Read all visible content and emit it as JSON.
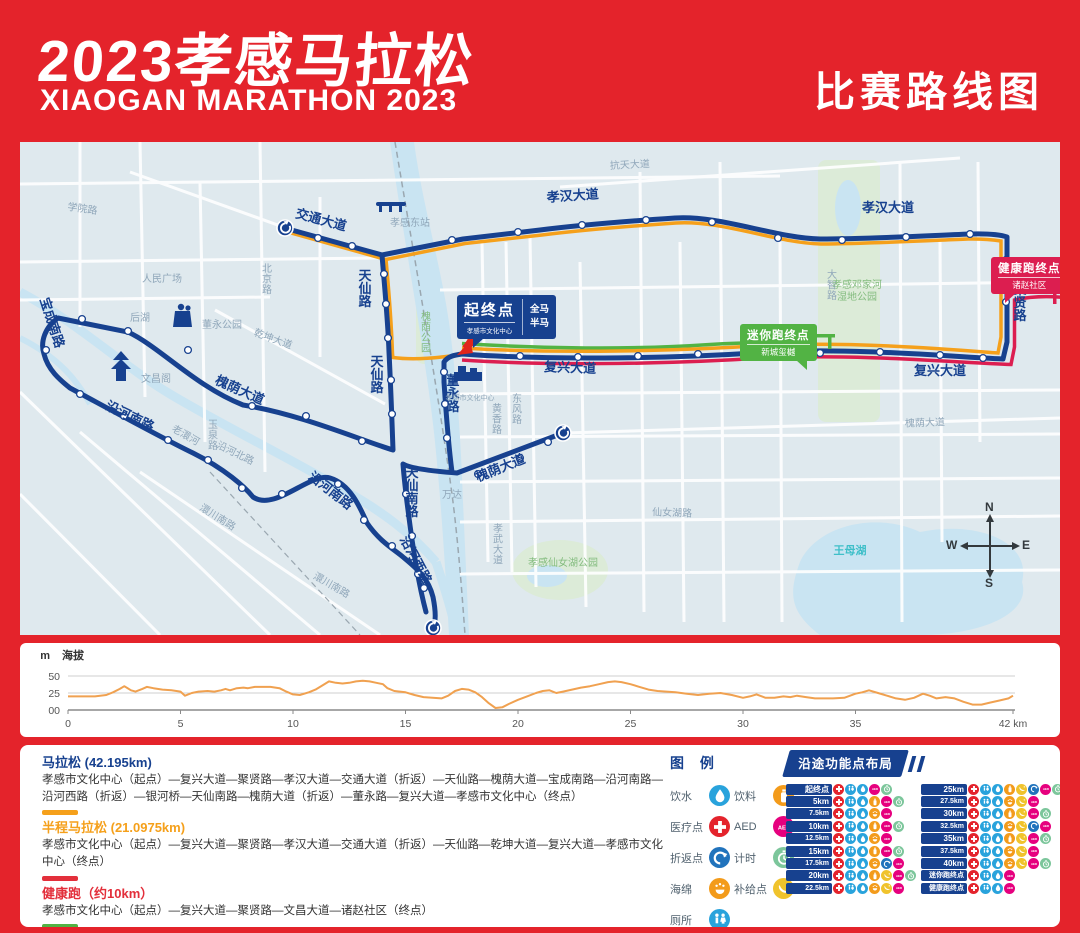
{
  "header": {
    "title_cn": "2023孝感马拉松",
    "title_en": "XIAOGAN MARATHON 2023",
    "right_label": "比赛路线图"
  },
  "map": {
    "start_callout": {
      "title": "起终点",
      "venue": "孝感市文化中心",
      "tag1": "全马",
      "tag2": "半马"
    },
    "mini_callout": {
      "title": "迷你跑终点",
      "venue": "新城玺樾"
    },
    "health_callout": {
      "title": "健康跑终点",
      "venue": "诸赵社区"
    },
    "compass": {
      "n": "N",
      "e": "E",
      "s": "S",
      "w": "W"
    },
    "labels": [
      {
        "t": "交通大道",
        "x": 300,
        "y": 82,
        "r": 15,
        "c": "rl"
      },
      {
        "t": "孝汉大道",
        "x": 553,
        "y": 58,
        "r": -4,
        "c": "rl"
      },
      {
        "t": "孝汉大道",
        "x": 868,
        "y": 70,
        "r": 0,
        "c": "rl"
      },
      {
        "t": "天仙路",
        "x": 345,
        "y": 138,
        "r": "V",
        "c": "rl"
      },
      {
        "t": "天仙路",
        "x": 357,
        "y": 224,
        "r": "V",
        "c": "rl"
      },
      {
        "t": "天仙南路",
        "x": 392,
        "y": 335,
        "r": "V",
        "c": "rl"
      },
      {
        "t": "聚贤路",
        "x": 1000,
        "y": 152,
        "r": "V",
        "c": "rl"
      },
      {
        "t": "董永路",
        "x": 433,
        "y": 243,
        "r": "V",
        "c": "rl"
      },
      {
        "t": "复兴大道",
        "x": 550,
        "y": 230,
        "r": 2,
        "c": "rl"
      },
      {
        "t": "复兴大道",
        "x": 920,
        "y": 233,
        "r": 0,
        "c": "rl"
      },
      {
        "t": "槐荫大道",
        "x": 218,
        "y": 252,
        "r": 24,
        "c": "rl"
      },
      {
        "t": "槐荫大道",
        "x": 482,
        "y": 330,
        "r": -22,
        "c": "rl"
      },
      {
        "t": "宝成南路",
        "x": 28,
        "y": 182,
        "r": 72,
        "c": "rl"
      },
      {
        "t": "沿河南路",
        "x": 108,
        "y": 278,
        "r": 26,
        "c": "rl"
      },
      {
        "t": "沿河南路",
        "x": 308,
        "y": 352,
        "r": 38,
        "c": "rl"
      },
      {
        "t": "沿河西路",
        "x": 392,
        "y": 420,
        "r": 62,
        "c": "rl"
      },
      {
        "t": "学院路",
        "x": 62,
        "y": 70,
        "r": 8,
        "c": "gl"
      },
      {
        "t": "人民广场",
        "x": 142,
        "y": 140,
        "r": 0,
        "c": "gl"
      },
      {
        "t": "后湖",
        "x": 120,
        "y": 179,
        "r": 0,
        "c": "gl"
      },
      {
        "t": "北京路",
        "x": 247,
        "y": 130,
        "r": "V",
        "c": "gl"
      },
      {
        "t": "孝感东站",
        "x": 390,
        "y": 84,
        "r": 0,
        "c": "gl"
      },
      {
        "t": "抗天大道",
        "x": 610,
        "y": 26,
        "r": -3,
        "c": "gl"
      },
      {
        "t": "乾坤大道",
        "x": 252,
        "y": 200,
        "r": 20,
        "c": "gl"
      },
      {
        "t": "董永公园",
        "x": 202,
        "y": 186,
        "r": 0,
        "c": "gl"
      },
      {
        "t": "文昌阁",
        "x": 136,
        "y": 240,
        "r": 0,
        "c": "gl"
      },
      {
        "t": "大智路",
        "x": 812,
        "y": 136,
        "r": "V",
        "c": "gl"
      },
      {
        "t": "槐荫大道",
        "x": 905,
        "y": 284,
        "r": -2,
        "c": "gl"
      },
      {
        "t": "仙女湖路",
        "x": 652,
        "y": 374,
        "r": 2,
        "c": "gl"
      },
      {
        "t": "孝武大道",
        "x": 478,
        "y": 390,
        "r": "V",
        "c": "gl"
      },
      {
        "t": "澴川南路",
        "x": 196,
        "y": 378,
        "r": 32,
        "c": "gl"
      },
      {
        "t": "澴川南路",
        "x": 310,
        "y": 446,
        "r": 30,
        "c": "gl"
      },
      {
        "t": "万达",
        "x": 432,
        "y": 356,
        "r": 0,
        "c": "gl"
      },
      {
        "t": "黄香路",
        "x": 477,
        "y": 270,
        "r": "V",
        "c": "gl"
      },
      {
        "t": "东风路",
        "x": 497,
        "y": 260,
        "r": "V",
        "c": "gl"
      },
      {
        "t": "玉泉路",
        "x": 193,
        "y": 286,
        "r": "V",
        "c": "gl"
      },
      {
        "t": "沿河北路",
        "x": 214,
        "y": 314,
        "r": 26,
        "c": "gl"
      },
      {
        "t": "老澴河",
        "x": 164,
        "y": 296,
        "r": 30,
        "c": "gl"
      },
      {
        "t": "槐荫公园",
        "x": 406,
        "y": 178,
        "r": "V",
        "c": "pk"
      },
      {
        "t": "孝感仙女湖公园",
        "x": 543,
        "y": 424,
        "r": 0,
        "c": "pk"
      },
      {
        "t": "孝感邓家河",
        "x": 837,
        "y": 146,
        "r": 0,
        "c": "pk"
      },
      {
        "t": "湿地公园",
        "x": 837,
        "y": 158,
        "r": 0,
        "c": "pk"
      },
      {
        "t": "王母湖",
        "x": 830,
        "y": 412,
        "r": 0,
        "c": "wl"
      },
      {
        "t": "孝感市文化中心",
        "x": 450,
        "y": 258,
        "r": 0,
        "c": "gl2"
      }
    ]
  },
  "elevation": {
    "unit": "m",
    "axis_label": "海拔",
    "yticks": [
      "50",
      "25",
      "00"
    ],
    "xtick_last": "42 km"
  },
  "chart_data": {
    "type": "line",
    "title": "海拔",
    "ylabel": "m",
    "xlabel": "km",
    "ylim": [
      0,
      50
    ],
    "yticks": [
      0,
      25,
      50
    ],
    "xticks": [
      0,
      5,
      10,
      15,
      20,
      25,
      30,
      35,
      42
    ],
    "legend_position": "none",
    "grid": true,
    "series": [
      {
        "name": "海拔",
        "color": "#F0A150",
        "points_km_m": [
          [
            0,
            20
          ],
          [
            0.7,
            20
          ],
          [
            1.2,
            20
          ],
          [
            1.7,
            22
          ],
          [
            2,
            26
          ],
          [
            2.3,
            31
          ],
          [
            2.5,
            35
          ],
          [
            2.8,
            29
          ],
          [
            3,
            27
          ],
          [
            3.3,
            31
          ],
          [
            3.5,
            34
          ],
          [
            3.8,
            32
          ],
          [
            4.2,
            30
          ],
          [
            4.6,
            29
          ],
          [
            5,
            27
          ],
          [
            5.2,
            21
          ],
          [
            5.5,
            25
          ],
          [
            5.8,
            27
          ],
          [
            6.2,
            28
          ],
          [
            6.5,
            27
          ],
          [
            6.8,
            29
          ],
          [
            7,
            31
          ],
          [
            7.2,
            29
          ],
          [
            7.5,
            32
          ],
          [
            7.8,
            33
          ],
          [
            8,
            32
          ],
          [
            8.3,
            34
          ],
          [
            8.7,
            34
          ],
          [
            9,
            34
          ],
          [
            9.4,
            32
          ],
          [
            9.7,
            27
          ],
          [
            10,
            23
          ],
          [
            10.3,
            22
          ],
          [
            10.7,
            26
          ],
          [
            11,
            30
          ],
          [
            11.3,
            36
          ],
          [
            11.6,
            42
          ],
          [
            11.9,
            40
          ],
          [
            12.2,
            39
          ],
          [
            12.5,
            40
          ],
          [
            12.8,
            42
          ],
          [
            13.1,
            43
          ],
          [
            13.4,
            42
          ],
          [
            13.7,
            40
          ],
          [
            14,
            38
          ],
          [
            14.2,
            32
          ],
          [
            14.5,
            28
          ],
          [
            15,
            26
          ],
          [
            15.4,
            22
          ],
          [
            15.8,
            19
          ],
          [
            16.2,
            18
          ],
          [
            16.6,
            17
          ],
          [
            16.9,
            21
          ],
          [
            17.2,
            28
          ],
          [
            17.5,
            31
          ],
          [
            17.8,
            30
          ],
          [
            18.1,
            26
          ],
          [
            18.4,
            19
          ],
          [
            18.7,
            10
          ],
          [
            19,
            3
          ],
          [
            19.3,
            4
          ],
          [
            19.6,
            9
          ],
          [
            20,
            15
          ],
          [
            20.4,
            20
          ],
          [
            20.8,
            25
          ],
          [
            21.1,
            28
          ],
          [
            21.4,
            29
          ],
          [
            21.7,
            25
          ],
          [
            22,
            27
          ],
          [
            22.4,
            30
          ],
          [
            22.8,
            33
          ],
          [
            23.2,
            35
          ],
          [
            23.6,
            38
          ],
          [
            24,
            41
          ],
          [
            24.3,
            42
          ],
          [
            24.6,
            41
          ],
          [
            25,
            38
          ],
          [
            25.4,
            34
          ],
          [
            25.8,
            30
          ],
          [
            26.2,
            28
          ],
          [
            26.6,
            27
          ],
          [
            27,
            26
          ],
          [
            27.5,
            24
          ],
          [
            28,
            22
          ],
          [
            28.5,
            24
          ],
          [
            29,
            25
          ],
          [
            29.5,
            22
          ],
          [
            30,
            18
          ],
          [
            30.3,
            20
          ],
          [
            30.6,
            23
          ],
          [
            31,
            18
          ],
          [
            31.4,
            18
          ],
          [
            31.8,
            20
          ],
          [
            32.1,
            19
          ],
          [
            32.4,
            21
          ],
          [
            32.8,
            19
          ],
          [
            33.2,
            17
          ],
          [
            33.6,
            17
          ],
          [
            34,
            17
          ],
          [
            34.5,
            18
          ],
          [
            35,
            24
          ],
          [
            35.3,
            26
          ],
          [
            35.6,
            29
          ],
          [
            36,
            25
          ],
          [
            36.4,
            21
          ],
          [
            36.8,
            17
          ],
          [
            37.2,
            15
          ],
          [
            37.6,
            18
          ],
          [
            38,
            24
          ],
          [
            38.3,
            21
          ],
          [
            38.6,
            17
          ],
          [
            39,
            19
          ],
          [
            39.4,
            17
          ],
          [
            39.8,
            12
          ],
          [
            40.2,
            8
          ],
          [
            40.6,
            8
          ],
          [
            41,
            11
          ],
          [
            41.4,
            14
          ],
          [
            41.8,
            17
          ],
          [
            42,
            21
          ]
        ]
      }
    ]
  },
  "routes": [
    {
      "name": "马拉松 (42.195km)",
      "color": "#17418F",
      "show_bar": false,
      "description": "孝感市文化中心（起点）—复兴大道—聚贤路—孝汉大道—交通大道（折返）—天仙路—槐荫大道—宝成南路—沿河南路—沿河西路（折返）—银河桥—天仙南路—槐荫大道（折返）—董永路—复兴大道—孝感市文化中心（终点）"
    },
    {
      "name": "半程马拉松 (21.0975km)",
      "color": "#F5A01B",
      "show_bar": true,
      "description": "孝感市文化中心（起点）—复兴大道—聚贤路—孝汉大道—交通大道（折返）—天仙路—乾坤大道—复兴大道—孝感市文化中心（终点）"
    },
    {
      "name": "健康跑（约10km）",
      "color": "#E32F3B",
      "show_bar": true,
      "description": "孝感市文化中心（起点）—复兴大道—聚贤路—文昌大道—诸赵社区（终点）"
    },
    {
      "name": "迷你跑（约5km）",
      "color": "#52B344",
      "show_bar": true,
      "description": "孝感市文化中心（起点）—复兴大道—新城玺樾（终点）"
    }
  ],
  "legend": {
    "title": "图 例",
    "columns": [
      [
        {
          "label": "饮水",
          "icon": "water",
          "color": "#29A3DC"
        },
        {
          "label": "医疗点",
          "icon": "medical",
          "color": "#E4232C"
        },
        {
          "label": "折返点",
          "icon": "turnaround",
          "color": "#2173BC"
        },
        {
          "label": "海绵",
          "icon": "sponge",
          "color": "#F39B1B"
        },
        {
          "label": "厕所",
          "icon": "toilet",
          "color": "#29A3DC"
        }
      ],
      [
        {
          "label": "饮料",
          "icon": "drink",
          "color": "#F39B1B"
        },
        {
          "label": "AED",
          "icon": "aed",
          "color": "#E6007E"
        },
        {
          "label": "计时",
          "icon": "timing",
          "color": "#7CC69B"
        },
        {
          "label": "补给点",
          "icon": "supply",
          "color": "#F0C32C"
        }
      ]
    ]
  },
  "stations": {
    "title": "沿途功能点布局",
    "columns": [
      [
        {
          "label": "起终点",
          "icons": [
            "medical",
            "toilet",
            "water",
            "aed",
            "timing"
          ]
        },
        {
          "label": "5km",
          "icons": [
            "medical",
            "toilet",
            "water",
            "drink",
            "aed",
            "timing"
          ]
        },
        {
          "label": "7.5km",
          "icons": [
            "medical",
            "toilet",
            "water",
            "sponge",
            "aed"
          ]
        },
        {
          "label": "10km",
          "icons": [
            "medical",
            "toilet",
            "water",
            "drink",
            "aed",
            "timing"
          ]
        },
        {
          "label": "12.5km",
          "icons": [
            "medical",
            "toilet",
            "water",
            "sponge",
            "aed"
          ]
        },
        {
          "label": "15km",
          "icons": [
            "medical",
            "toilet",
            "water",
            "drink",
            "aed",
            "timing"
          ]
        },
        {
          "label": "17.5km",
          "icons": [
            "medical",
            "toilet",
            "water",
            "sponge",
            "turnaround",
            "aed"
          ]
        },
        {
          "label": "20km",
          "icons": [
            "medical",
            "toilet",
            "water",
            "drink",
            "supply",
            "aed",
            "timing"
          ]
        },
        {
          "label": "22.5km",
          "icons": [
            "medical",
            "toilet",
            "water",
            "sponge",
            "supply",
            "aed"
          ]
        }
      ],
      [
        {
          "label": "25km",
          "icons": [
            "medical",
            "toilet",
            "water",
            "drink",
            "supply",
            "turnaround",
            "aed",
            "timing"
          ]
        },
        {
          "label": "27.5km",
          "icons": [
            "medical",
            "toilet",
            "water",
            "sponge",
            "supply",
            "aed"
          ]
        },
        {
          "label": "30km",
          "icons": [
            "medical",
            "toilet",
            "water",
            "drink",
            "supply",
            "aed",
            "timing"
          ]
        },
        {
          "label": "32.5km",
          "icons": [
            "medical",
            "toilet",
            "water",
            "sponge",
            "supply",
            "turnaround",
            "aed"
          ]
        },
        {
          "label": "35km",
          "icons": [
            "medical",
            "toilet",
            "water",
            "drink",
            "supply",
            "aed",
            "timing"
          ]
        },
        {
          "label": "37.5km",
          "icons": [
            "medical",
            "toilet",
            "water",
            "sponge",
            "supply",
            "aed"
          ]
        },
        {
          "label": "40km",
          "icons": [
            "medical",
            "toilet",
            "water",
            "sponge",
            "supply",
            "aed",
            "timing"
          ]
        },
        {
          "label": "迷你跑终点",
          "icons": [
            "medical",
            "toilet",
            "water",
            "aed"
          ]
        },
        {
          "label": "健康跑终点",
          "icons": [
            "medical",
            "toilet",
            "water",
            "aed"
          ]
        }
      ]
    ]
  }
}
